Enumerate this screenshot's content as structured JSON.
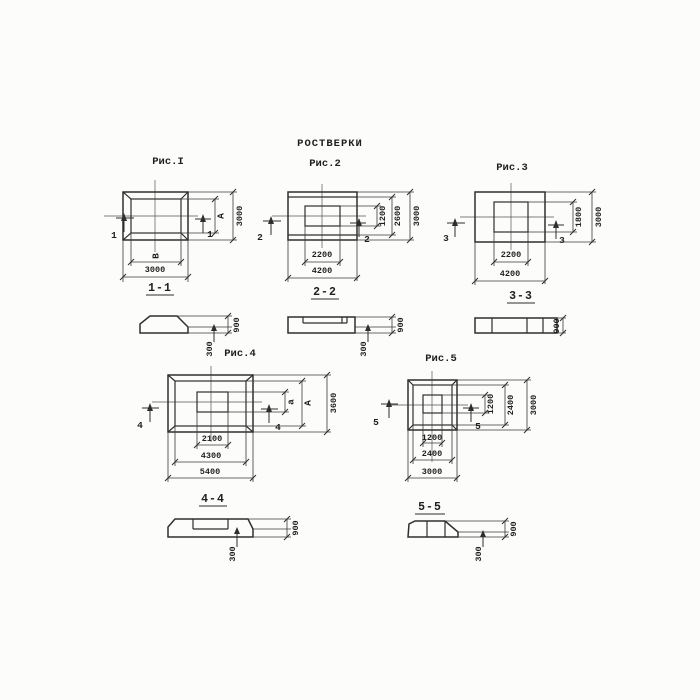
{
  "title": "РОСТВЕРКИ",
  "figures": {
    "fig1": {
      "label": "Рис.I",
      "cut_number": "1",
      "section_label": "1-1",
      "dims": {
        "right_inner": "А",
        "right_outer": "3000",
        "bottom_inner": "В",
        "bottom_outer": "3000"
      }
    },
    "fig2": {
      "label": "Рис.2",
      "cut_number": "2",
      "section_label": "2-2",
      "dims": {
        "right_inner": "1200",
        "right_mid": "2600",
        "right_outer": "3000",
        "bottom_inner": "2200",
        "bottom_outer": "4200"
      }
    },
    "fig3": {
      "label": "Рис.3",
      "cut_number": "3",
      "section_label": "3-3",
      "dims": {
        "right_inner": "1800",
        "right_outer": "3000",
        "bottom_inner": "2200",
        "bottom_outer": "4200"
      }
    },
    "fig4": {
      "label": "Рис.4",
      "cut_number": "4",
      "section_label": "4-4",
      "dims": {
        "right_inner": "а",
        "right_mid": "А",
        "right_outer": "3600",
        "bottom_inner": "2100",
        "bottom_mid": "4300",
        "bottom_outer": "5400"
      }
    },
    "fig5": {
      "label": "Рис.5",
      "cut_number": "5",
      "section_label": "5-5",
      "dims": {
        "right_inner": "1200",
        "right_mid": "2400",
        "right_outer": "3000",
        "bottom_inner": "1200",
        "bottom_mid": "2400",
        "bottom_outer": "3000"
      }
    }
  },
  "sections": {
    "s1": {
      "total_height": "900",
      "edge_height": "300"
    },
    "s2": {
      "total_height": "900",
      "edge_height": "300"
    },
    "s3": {
      "total_height": "900"
    },
    "s4": {
      "total_height": "900",
      "edge_height": "300"
    },
    "s5": {
      "total_height": "900",
      "edge_height": "300"
    }
  },
  "colors": {
    "line": "#2e2e2e",
    "background": "#fcfcfa"
  }
}
